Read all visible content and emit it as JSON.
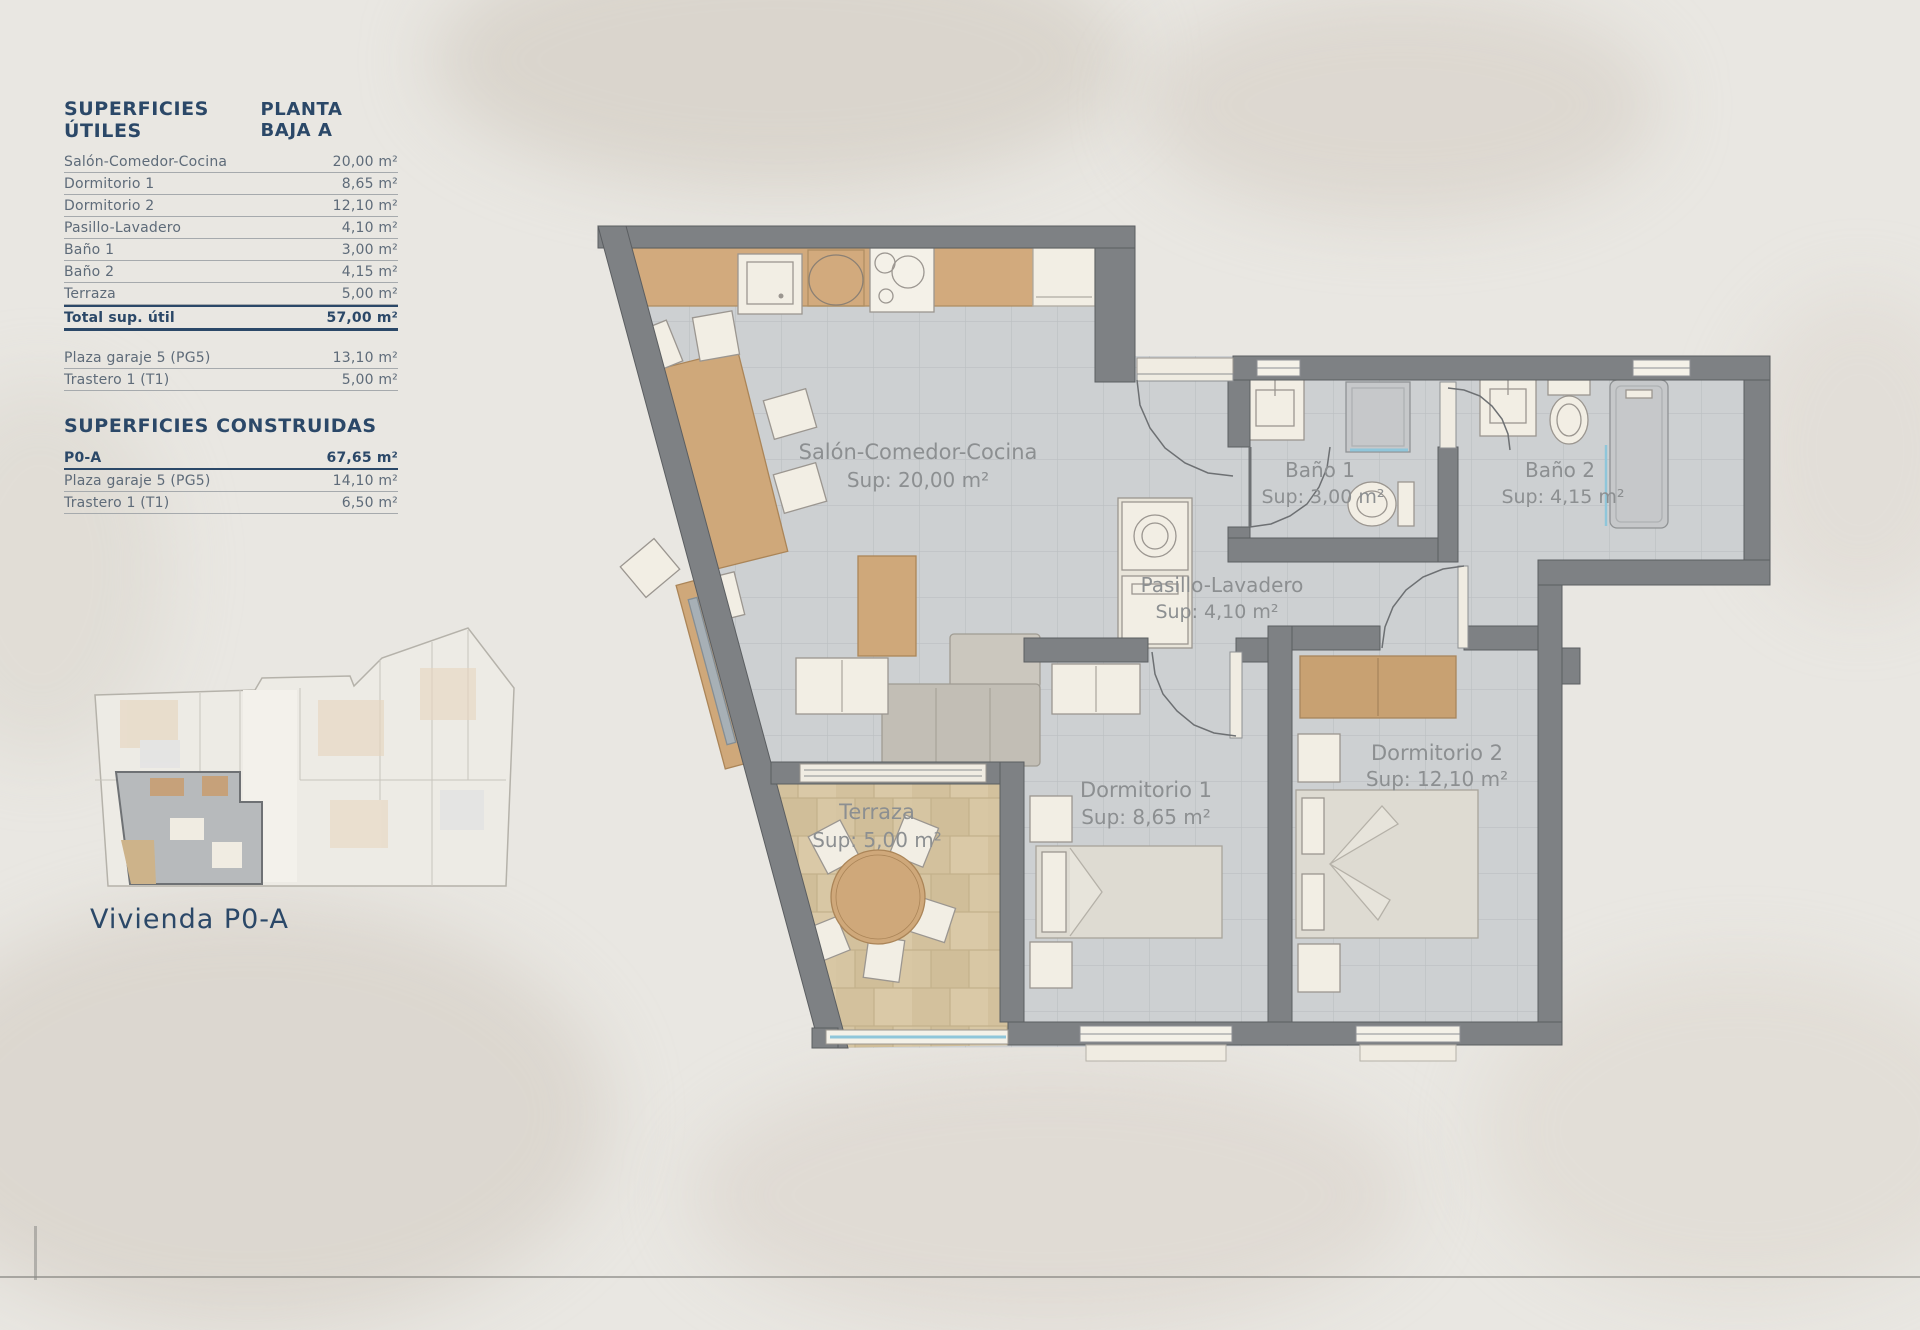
{
  "panel": {
    "utiles": {
      "title": "SUPERFICIES ÚTILES",
      "plan_title": "PLANTA BAJA A",
      "rows": [
        {
          "label": "Salón-Comedor-Cocina",
          "value": "20,00 m²"
        },
        {
          "label": "Dormitorio 1",
          "value": "8,65 m²"
        },
        {
          "label": "Dormitorio 2",
          "value": "12,10 m²"
        },
        {
          "label": "Pasillo-Lavadero",
          "value": "4,10 m²"
        },
        {
          "label": "Baño 1",
          "value": "3,00 m²"
        },
        {
          "label": "Baño 2",
          "value": "4,15 m²"
        },
        {
          "label": "Terraza",
          "value": "5,00 m²"
        }
      ],
      "total": {
        "label": "Total sup. útil",
        "value": "57,00 m²"
      },
      "extras": [
        {
          "label": "Plaza garaje 5 (PG5)",
          "value": "13,10 m²"
        },
        {
          "label": "Trastero 1 (T1)",
          "value": "5,00 m²"
        }
      ]
    },
    "construidas": {
      "title": "SUPERFICIES CONSTRUIDAS",
      "rows": [
        {
          "label": "P0-A",
          "value": "67,65 m²"
        },
        {
          "label": "Plaza garaje 5 (PG5)",
          "value": "14,10 m²"
        },
        {
          "label": "Trastero 1 (T1)",
          "value": "6,50 m²"
        }
      ]
    }
  },
  "mini_plan": {
    "caption": "Vivienda P0-A"
  },
  "floor_plan": {
    "rooms": [
      {
        "name": "Salón-Comedor-Cocina",
        "sup": "Sup: 20,00 m²"
      },
      {
        "name": "Baño 1",
        "sup": "Sup: 3,00 m²"
      },
      {
        "name": "Baño 2",
        "sup": "Sup: 4,15 m²"
      },
      {
        "name": "Pasillo-Lavadero",
        "sup": "Sup: 4,10 m²"
      },
      {
        "name": "Dormitorio 1",
        "sup": "Sup: 8,65 m²"
      },
      {
        "name": "Dormitorio 2",
        "sup": "Sup: 12,10 m²"
      },
      {
        "name": "Terraza",
        "sup": "Sup: 5,00 m²"
      }
    ],
    "colors": {
      "navy": "#2b4868",
      "wall_gray": "#7e8184",
      "wood": "#d2aa7d",
      "terrace_tile": "#d8c7a4",
      "floor_tile": "#cdd0d2",
      "glass_blue": "#8fc6da",
      "label_gray": "#8c8f91"
    }
  }
}
